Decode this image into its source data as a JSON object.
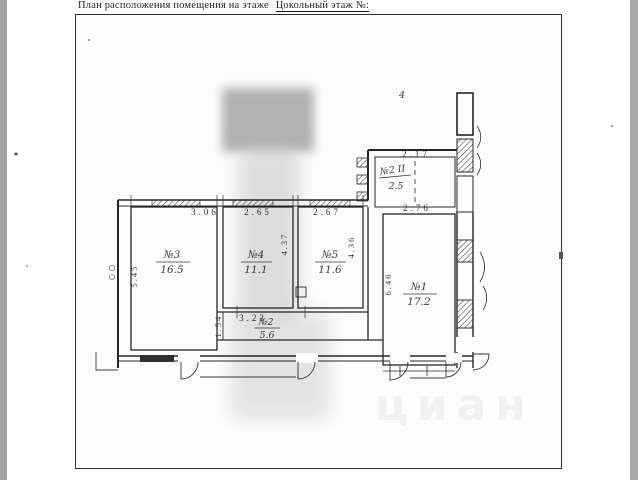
{
  "title": {
    "prefix": "План расположения помещения на этаже",
    "floor_label": "Цокольный этаж №:"
  },
  "plan": {
    "rooms": {
      "room3": {
        "number": "№3",
        "area": "16.5",
        "width_m": "3.06",
        "depth_m": "5.45"
      },
      "room4": {
        "number": "№4",
        "area": "11.1",
        "width_m": "2.65",
        "depth_m": "4.37"
      },
      "room5": {
        "number": "№5",
        "area": "11.6",
        "width_m": "2.67",
        "depth_m": "4.36"
      },
      "room1": {
        "number": "№1",
        "area": "17.2",
        "width_m": "2.76",
        "depth_m": "6.46"
      },
      "corridor2": {
        "number": "№2",
        "area": "5.6",
        "width_m": "3.23",
        "depth_m": "1.54"
      },
      "upper2": {
        "number": "№2 II",
        "area": "2.5",
        "width_m": "2.17"
      }
    },
    "handwritten_mark": "4",
    "watermark": "циан"
  }
}
